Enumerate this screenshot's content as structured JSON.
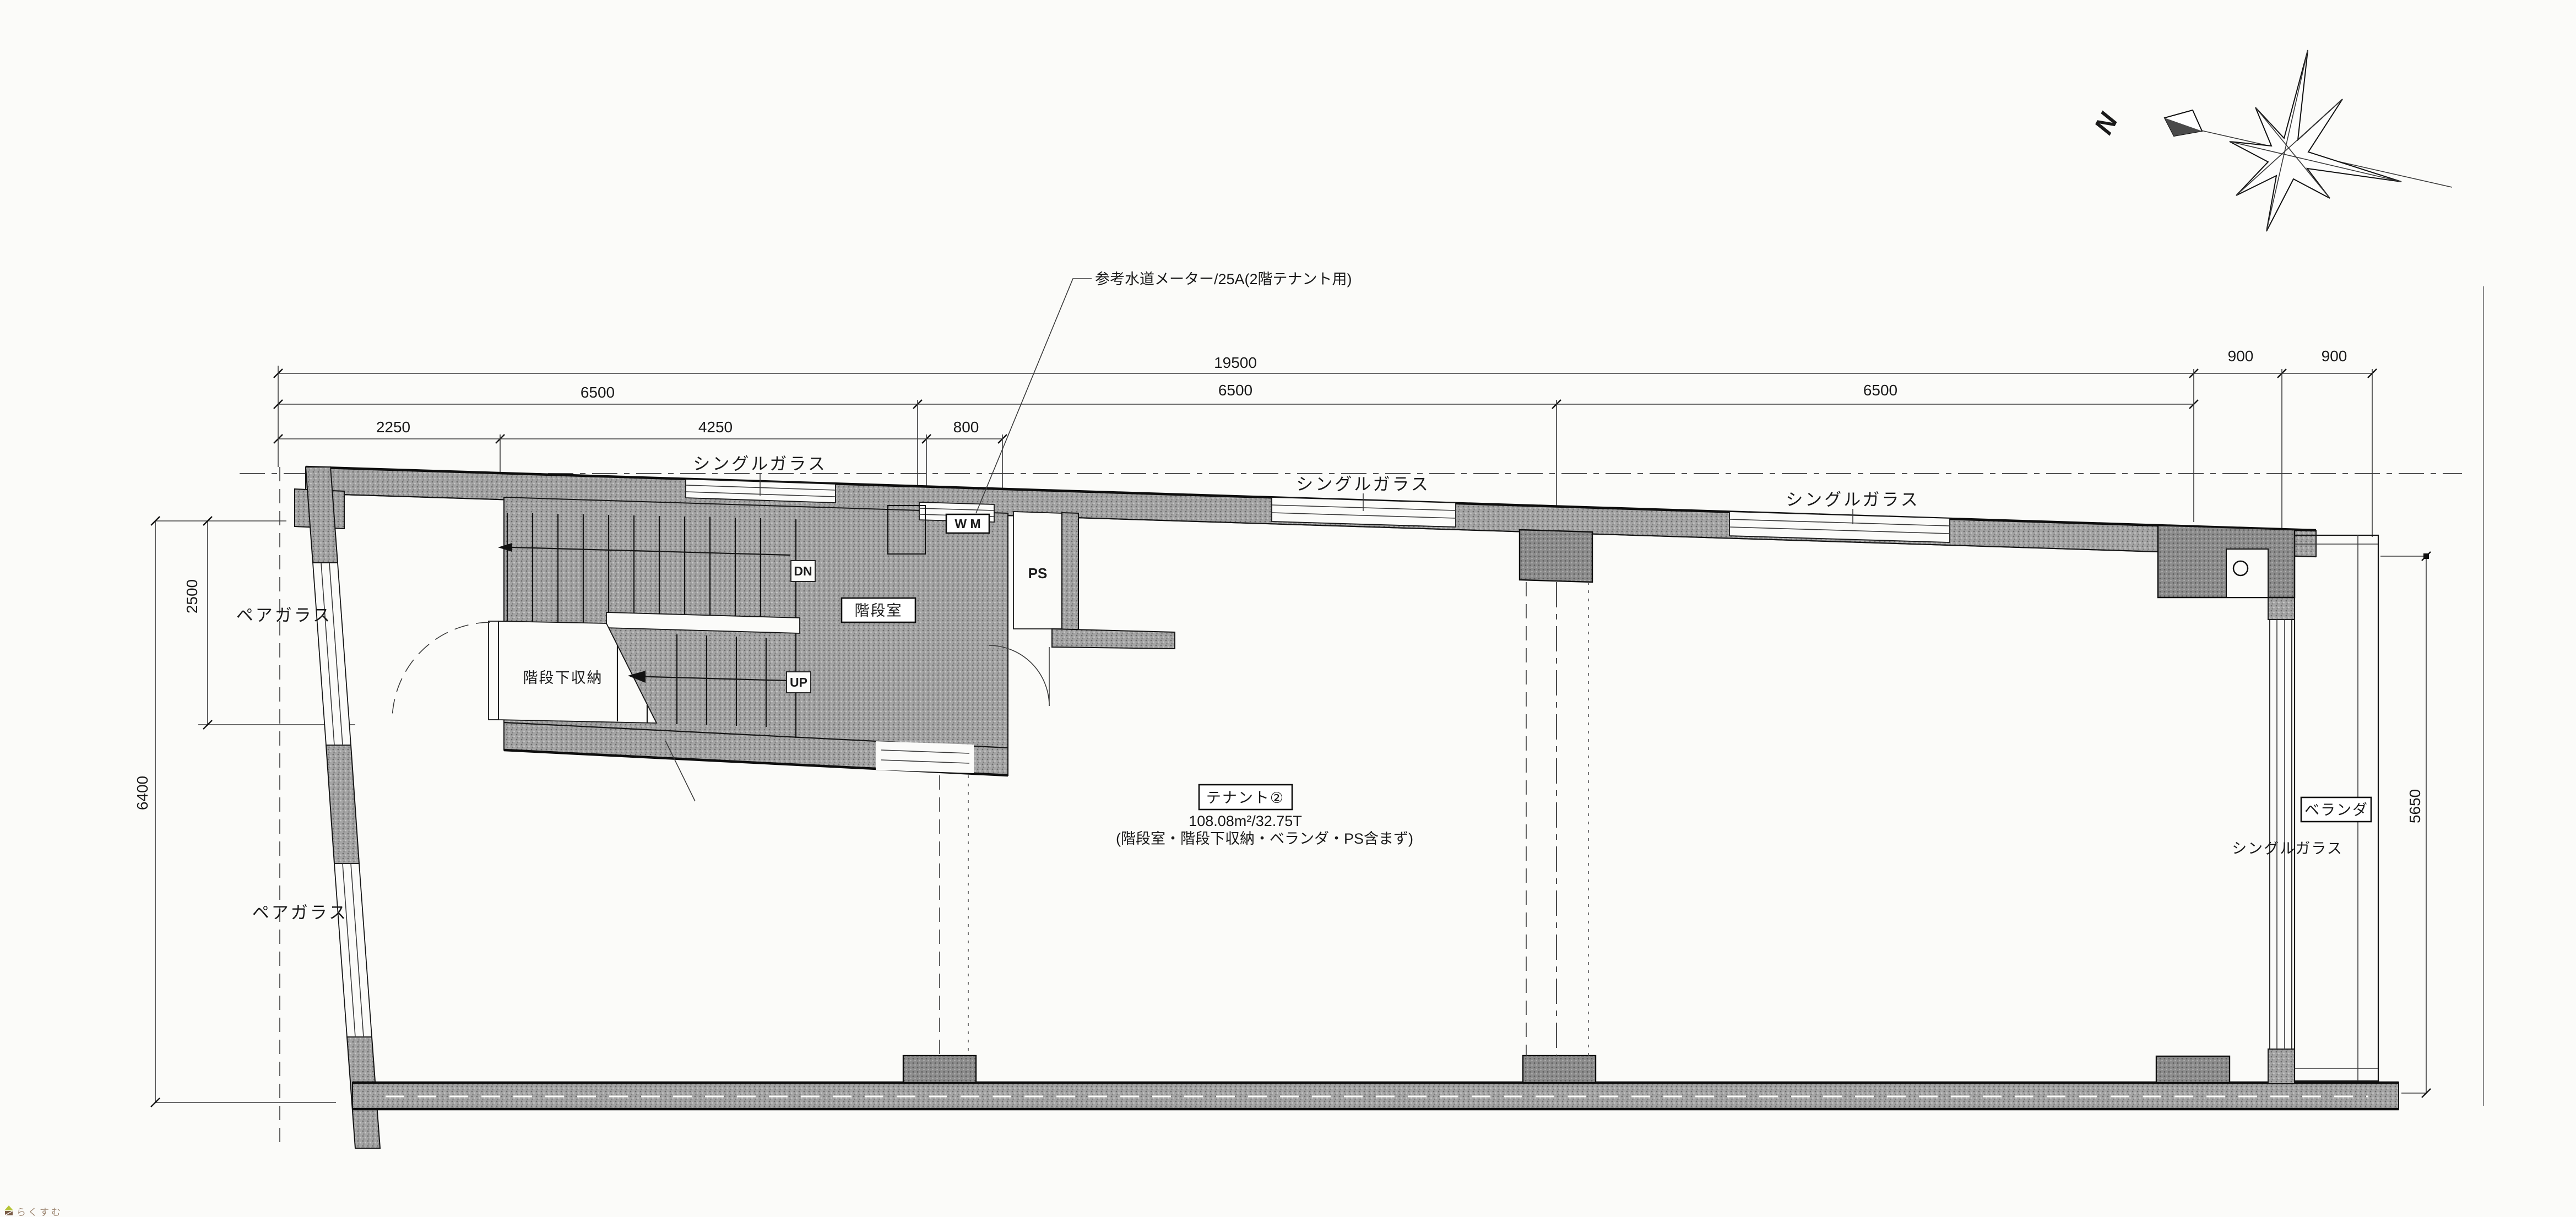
{
  "compass": {
    "north_label": "N"
  },
  "annotation": {
    "water_meter": "参考水道メーター/25A(2階テナント用)"
  },
  "dims": {
    "total_width": "19500",
    "veranda_1": "900",
    "veranda_2": "900",
    "bay_1": "6500",
    "bay_2": "6500",
    "bay_3": "6500",
    "sub_1": "2250",
    "sub_2": "4250",
    "sub_3": "800",
    "left_upper": "2500",
    "left_total": "6400",
    "right_height": "5650"
  },
  "labels": {
    "single_glass": "シングルガラス",
    "pair_glass": "ペアガラス",
    "veranda": "ベランダ",
    "stair_room": "階段室",
    "under_stair_storage": "階段下収納",
    "pipe_space": "PS",
    "washing_machine": "W M",
    "down": "DN",
    "up": "UP"
  },
  "tenant": {
    "name": "テナント②",
    "area": "108.08m²/32.75T",
    "note": "(階段室・階段下収納・ベランダ・PS含まず)"
  },
  "logo": {
    "text": "らくすむ"
  },
  "colors": {
    "wall_hatch": "#a4a4a4",
    "column_hatch": "#8c8c8c",
    "line": "#1a1a1a",
    "logo_text": "#a08a76",
    "logo_roof": "#b5c437",
    "logo_body": "#7a5c48"
  }
}
